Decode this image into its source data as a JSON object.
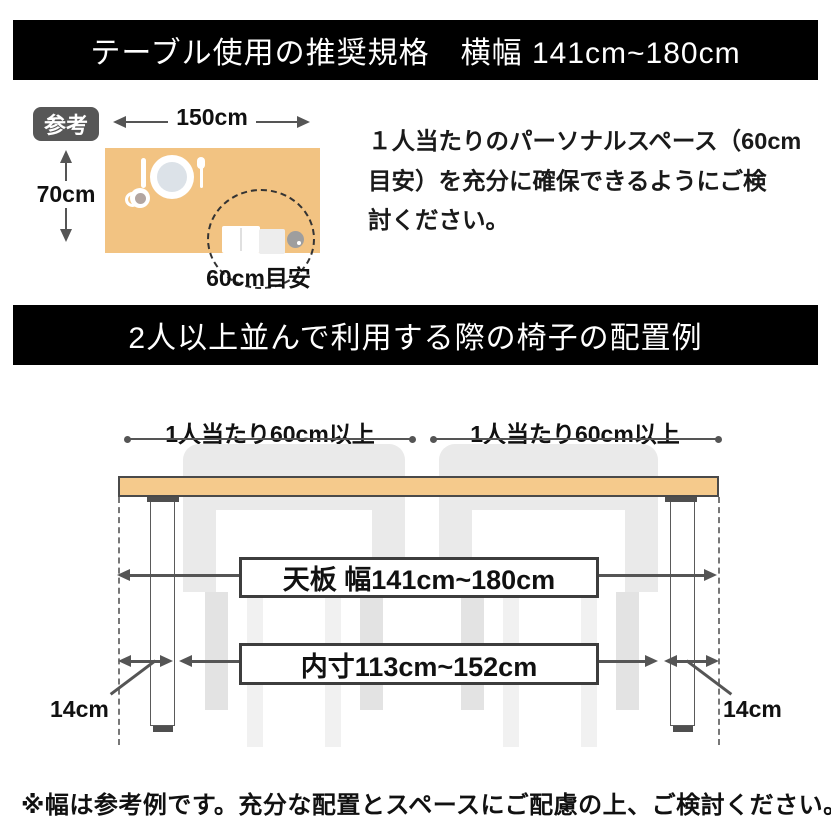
{
  "top_banner": {
    "title": "テーブル使用の推奨規格　横幅 141cm~180cm"
  },
  "reference_diagram": {
    "badge": "参考",
    "width_label": "150cm",
    "depth_label": "70cm",
    "space_label": "60cm目安",
    "description_lines": [
      "１人当たりのパーソナルスペース（60cm",
      "目安）を充分に確保できるようにご検",
      "討ください。"
    ]
  },
  "middle_banner": {
    "title": "2人以上並んで利用する際の椅子の配置例"
  },
  "arrangement_diagram": {
    "per_person_left": "1人当たり60cm以上",
    "per_person_right": "1人当たり60cm以上",
    "tabletop_label": "天板 幅141cm~180cm",
    "inner_label": "内寸113cm~152cm",
    "leg_offset_left": "14cm",
    "leg_offset_right": "14cm"
  },
  "footnote": "※幅は参考例です。充分な配置とスペースにご配慮の上、ご検討ください。",
  "colors": {
    "banner_bg": "#000000",
    "banner_text": "#ffffff",
    "table_surface": "#F2C382",
    "tabletop_fill": "#F5CA8C",
    "line": "#555555",
    "chair": "#EAEAEA",
    "badge_bg": "#575757"
  }
}
